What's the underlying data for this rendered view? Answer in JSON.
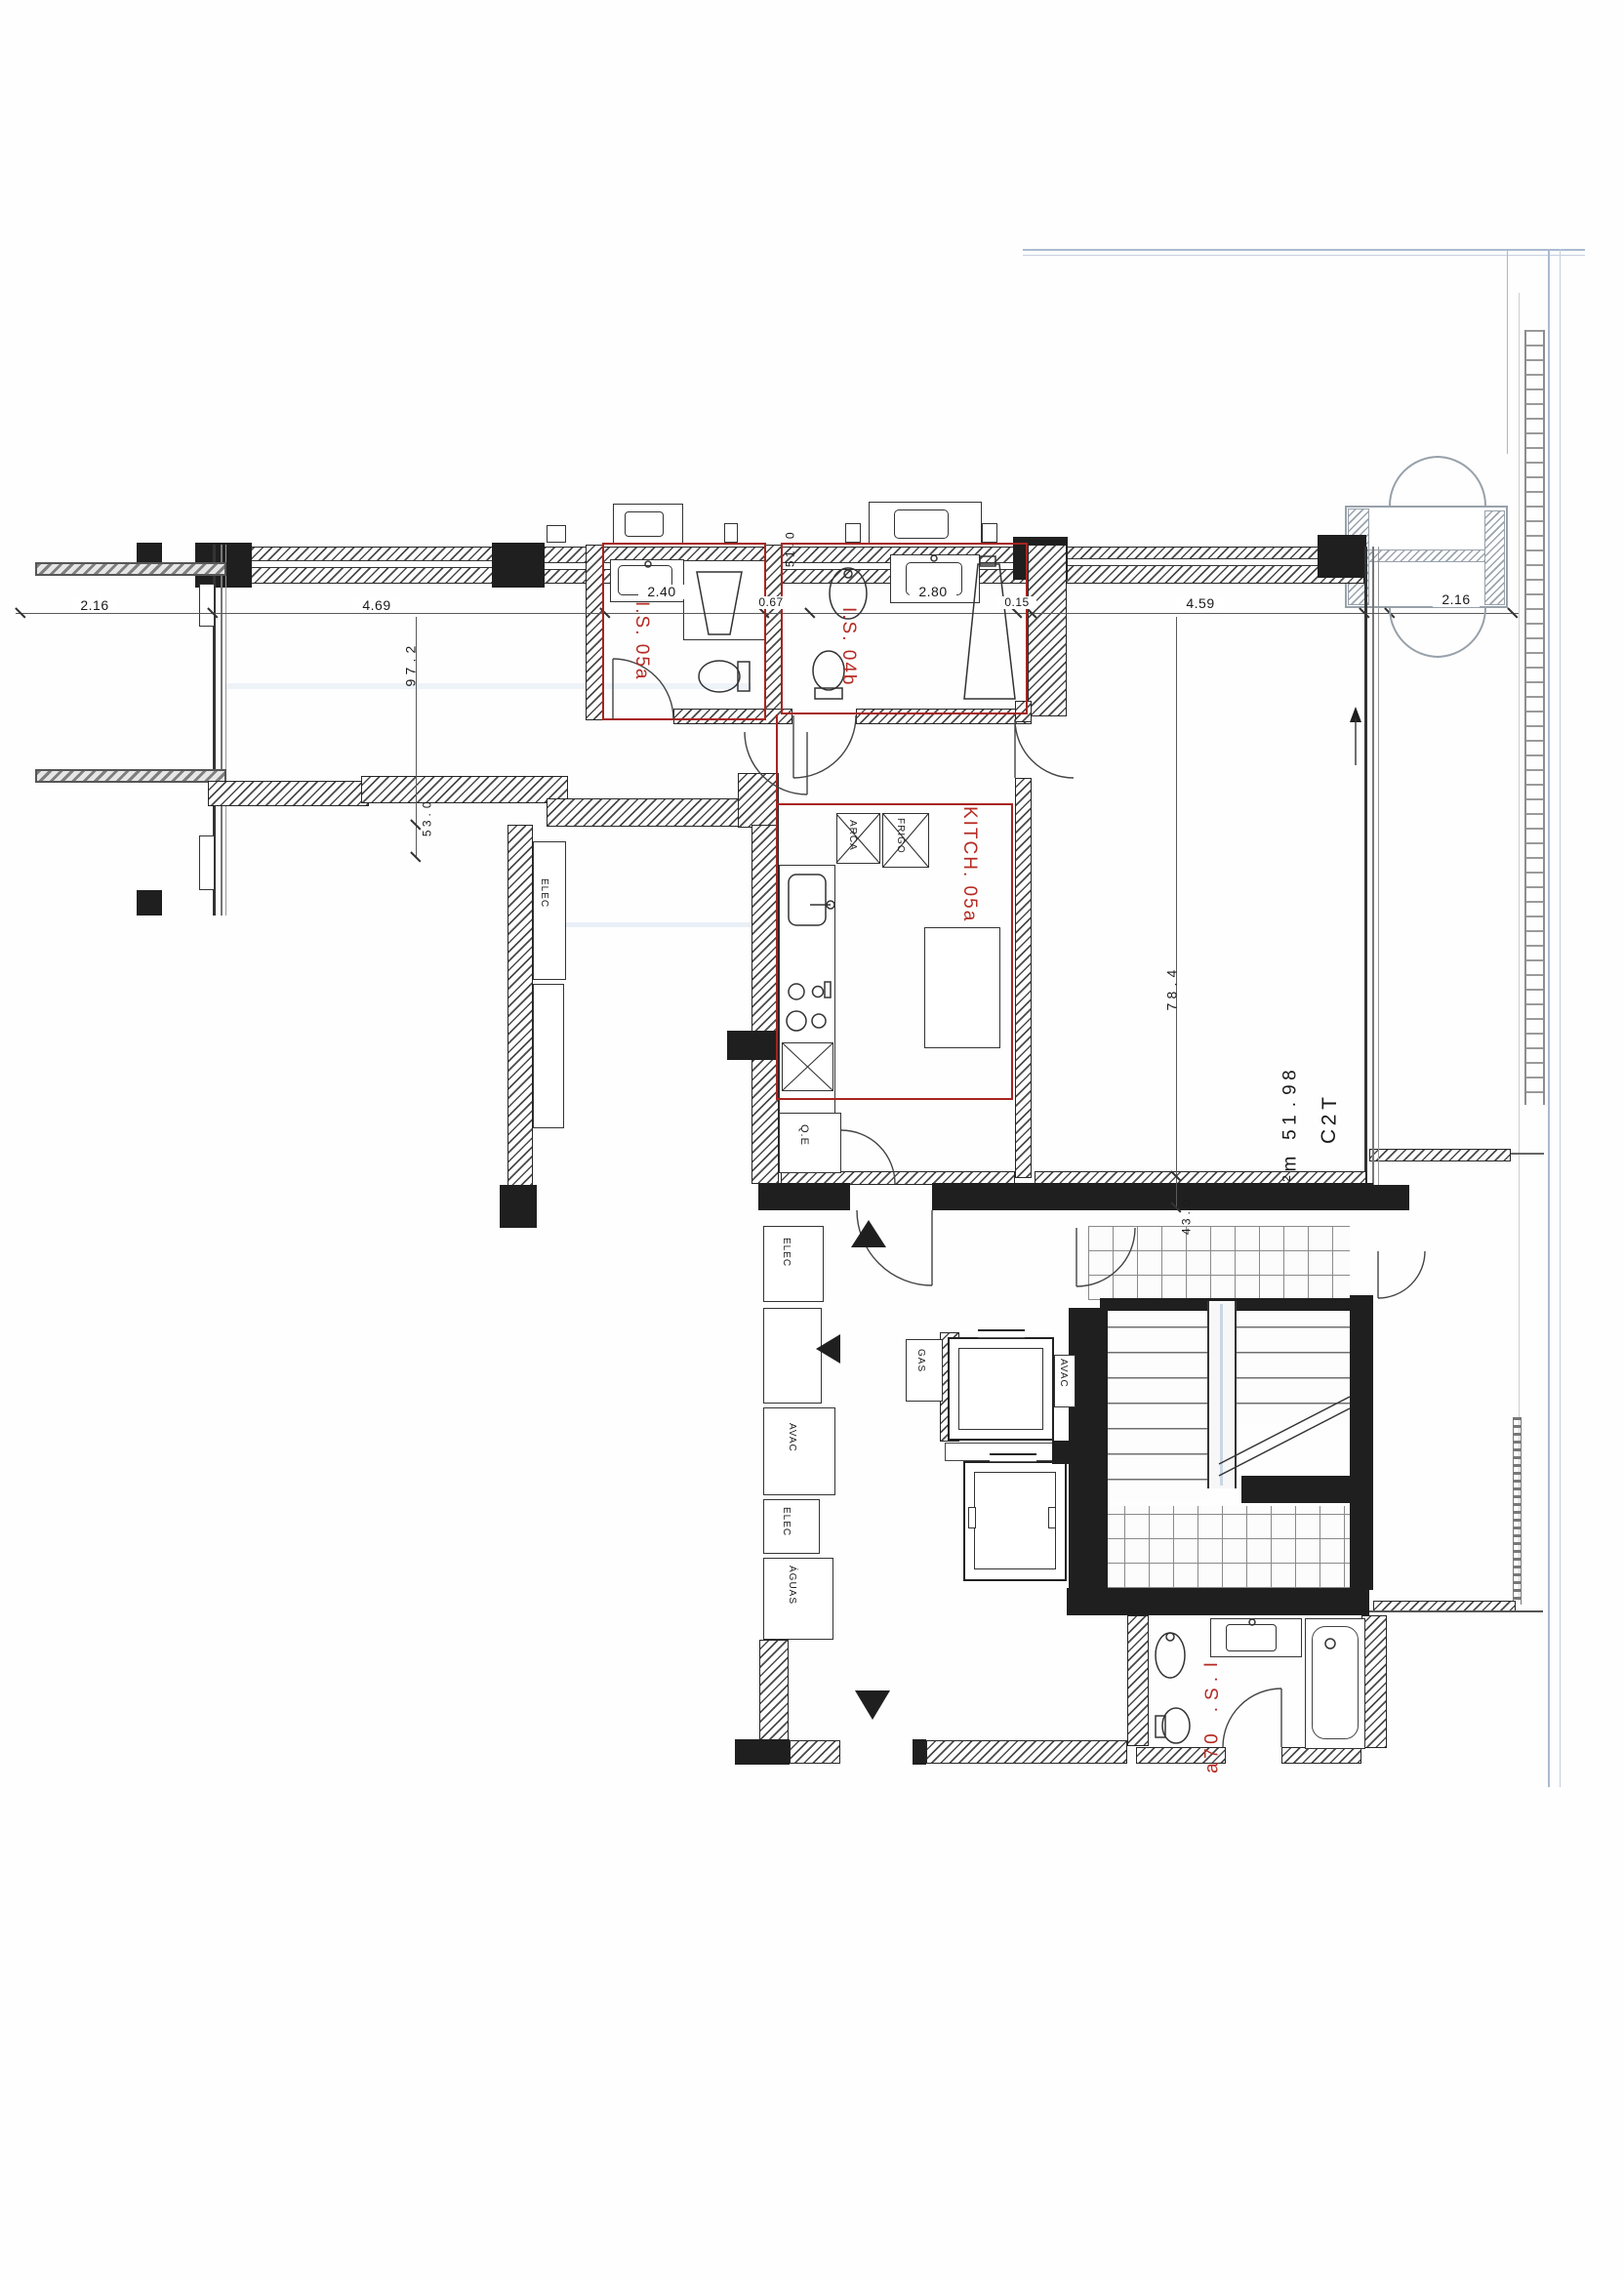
{
  "drawing": {
    "unit_label": "T2C",
    "area_label": "89.15 m²",
    "rooms": {
      "bath_a": "I.S. 05a",
      "bath_b": "I.S. 04b",
      "kitchen": "KITCH. 05a",
      "bath_c": "I.S. 07a"
    },
    "equipment": {
      "arca": "ARCA",
      "frigo": "FRIGO",
      "qe": "Q.E",
      "gas": "GAS",
      "avac1": "AVAC",
      "avac2": "AVAC",
      "elec1": "ELEC",
      "elec2": "ELEC",
      "elec3": "ELEC",
      "aguas": "ÁGUAS"
    },
    "dims_h": {
      "d216_left": "2.16",
      "d469": "4.69",
      "d240": "2.40",
      "d067": "0.67",
      "d280": "2.80",
      "d015": "0.15",
      "d459": "4.59",
      "d216_right": "2.16"
    },
    "dims_v": {
      "d279": "2.79",
      "d035": "0.35",
      "d015v": "0.15",
      "d487": "4.87",
      "d034": "0.34"
    },
    "colors": {
      "red": "#b52a22",
      "wall_black": "#1f1f1f",
      "facade_blue": "#a9bbd1",
      "balcony_gray": "#98a1aa"
    }
  }
}
